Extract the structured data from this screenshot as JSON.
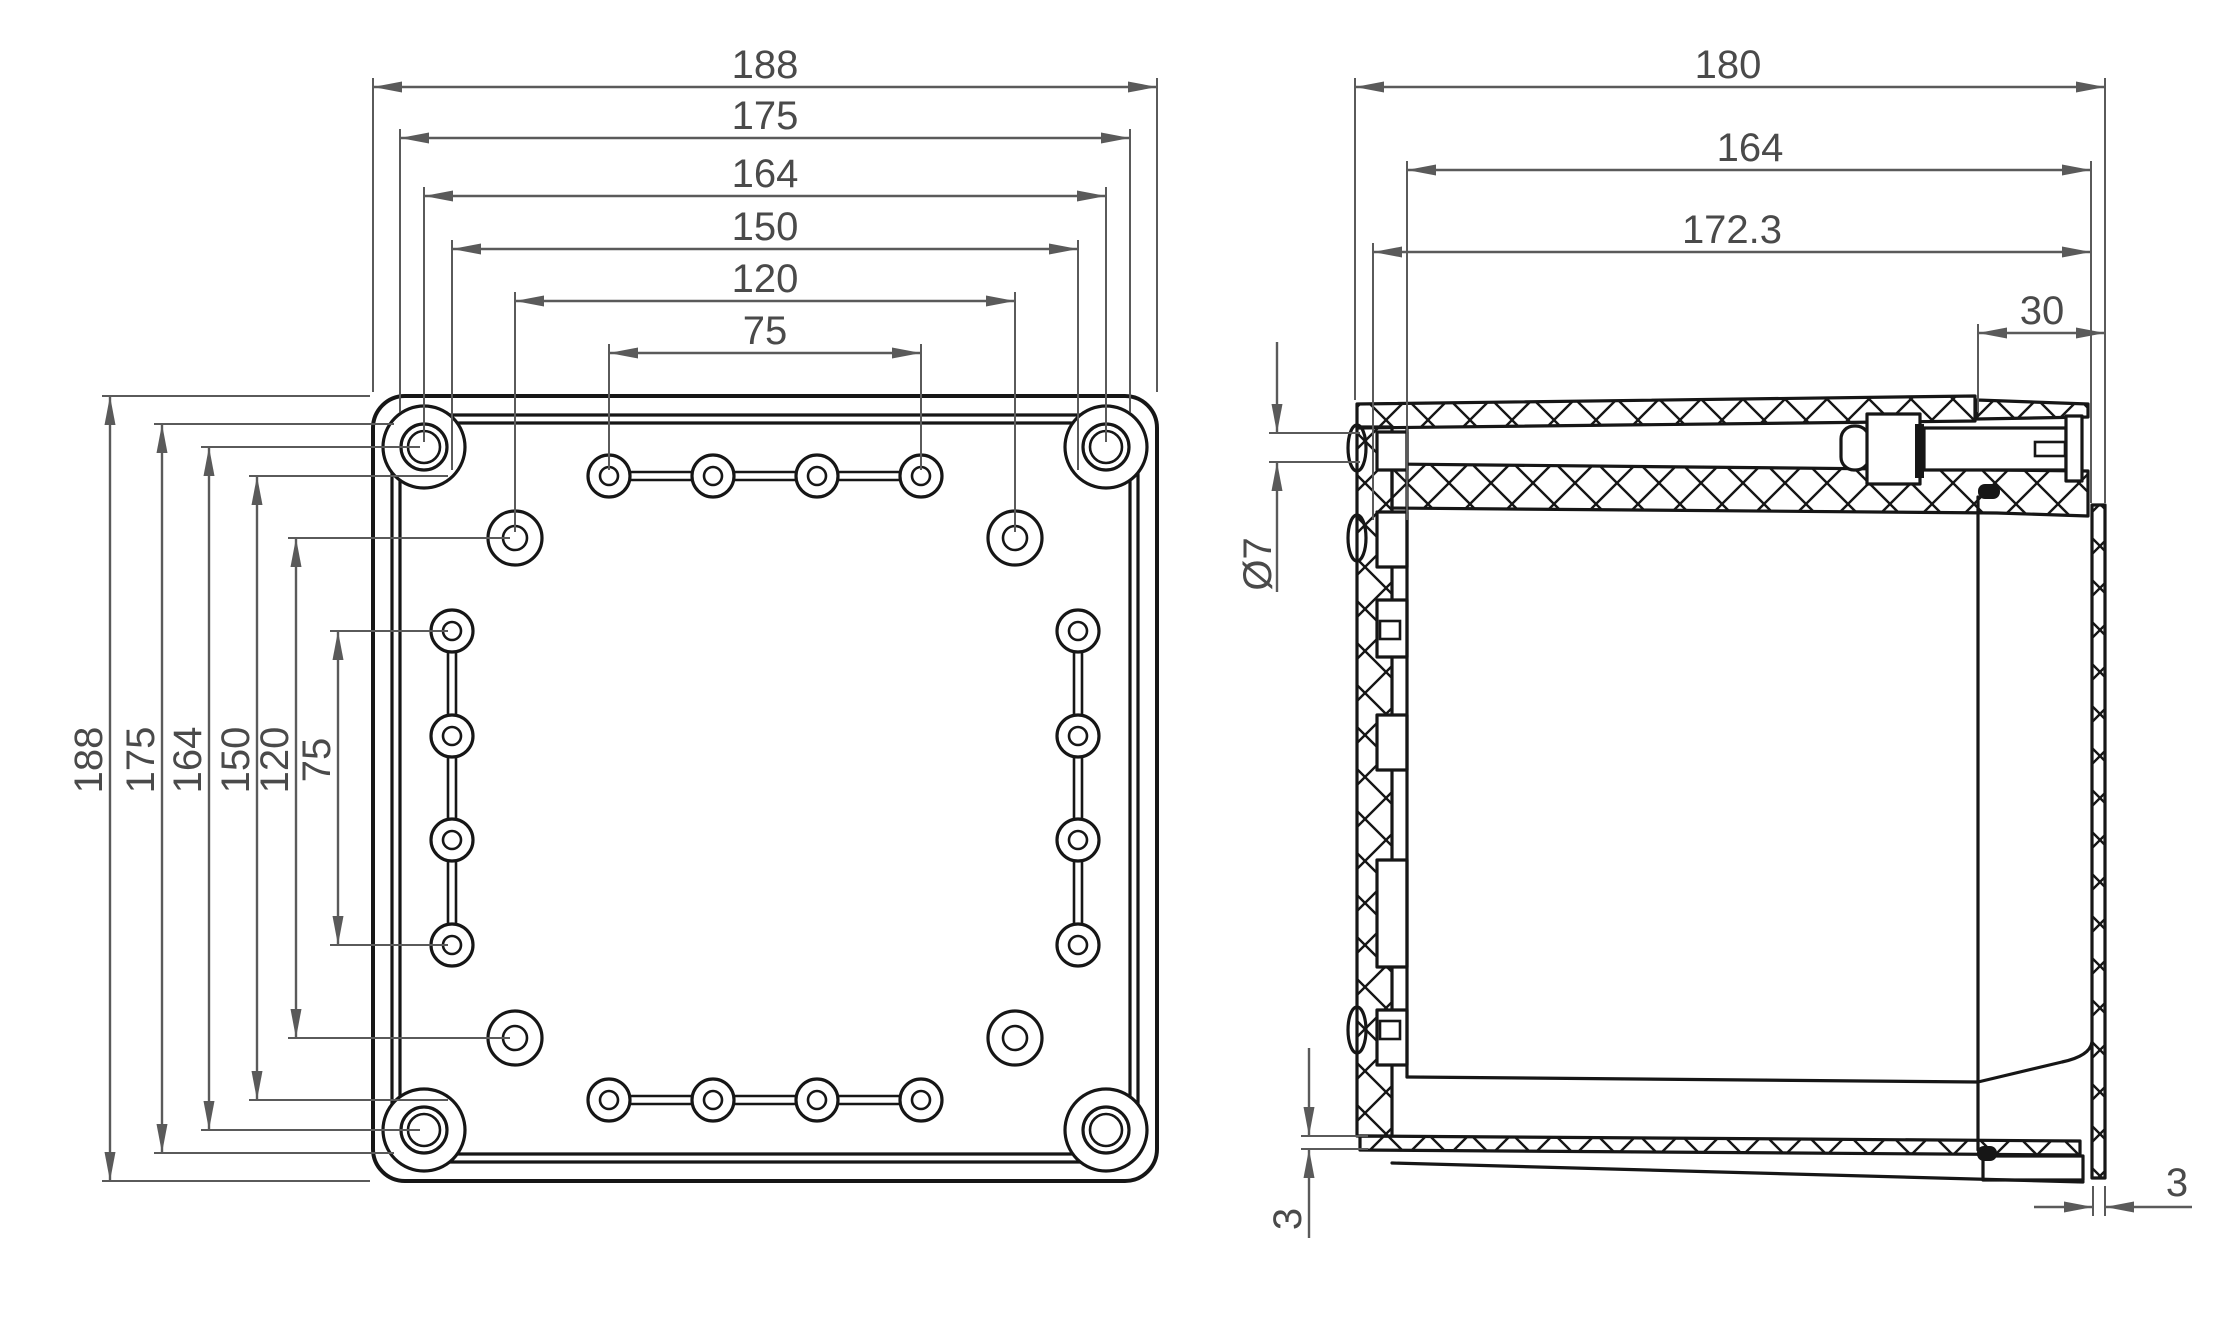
{
  "meta": {
    "title": "Enclosure dimensional drawing",
    "background_color": "#ffffff",
    "geometry_color": "#161616",
    "dimension_color": "#5a5a5a",
    "views": [
      "front-view",
      "side-section-view"
    ]
  },
  "front_view": {
    "top_dims": [
      "188",
      "175",
      "164",
      "150",
      "120",
      "75"
    ],
    "left_dims": [
      "188",
      "175",
      "164",
      "150",
      "120",
      "75"
    ]
  },
  "side_view": {
    "top_dims": [
      "180",
      "164",
      "172.3",
      "30"
    ],
    "hole_diameter": "Ø7",
    "bottom_wall_thickness": "3",
    "right_wall_thickness": "3"
  }
}
